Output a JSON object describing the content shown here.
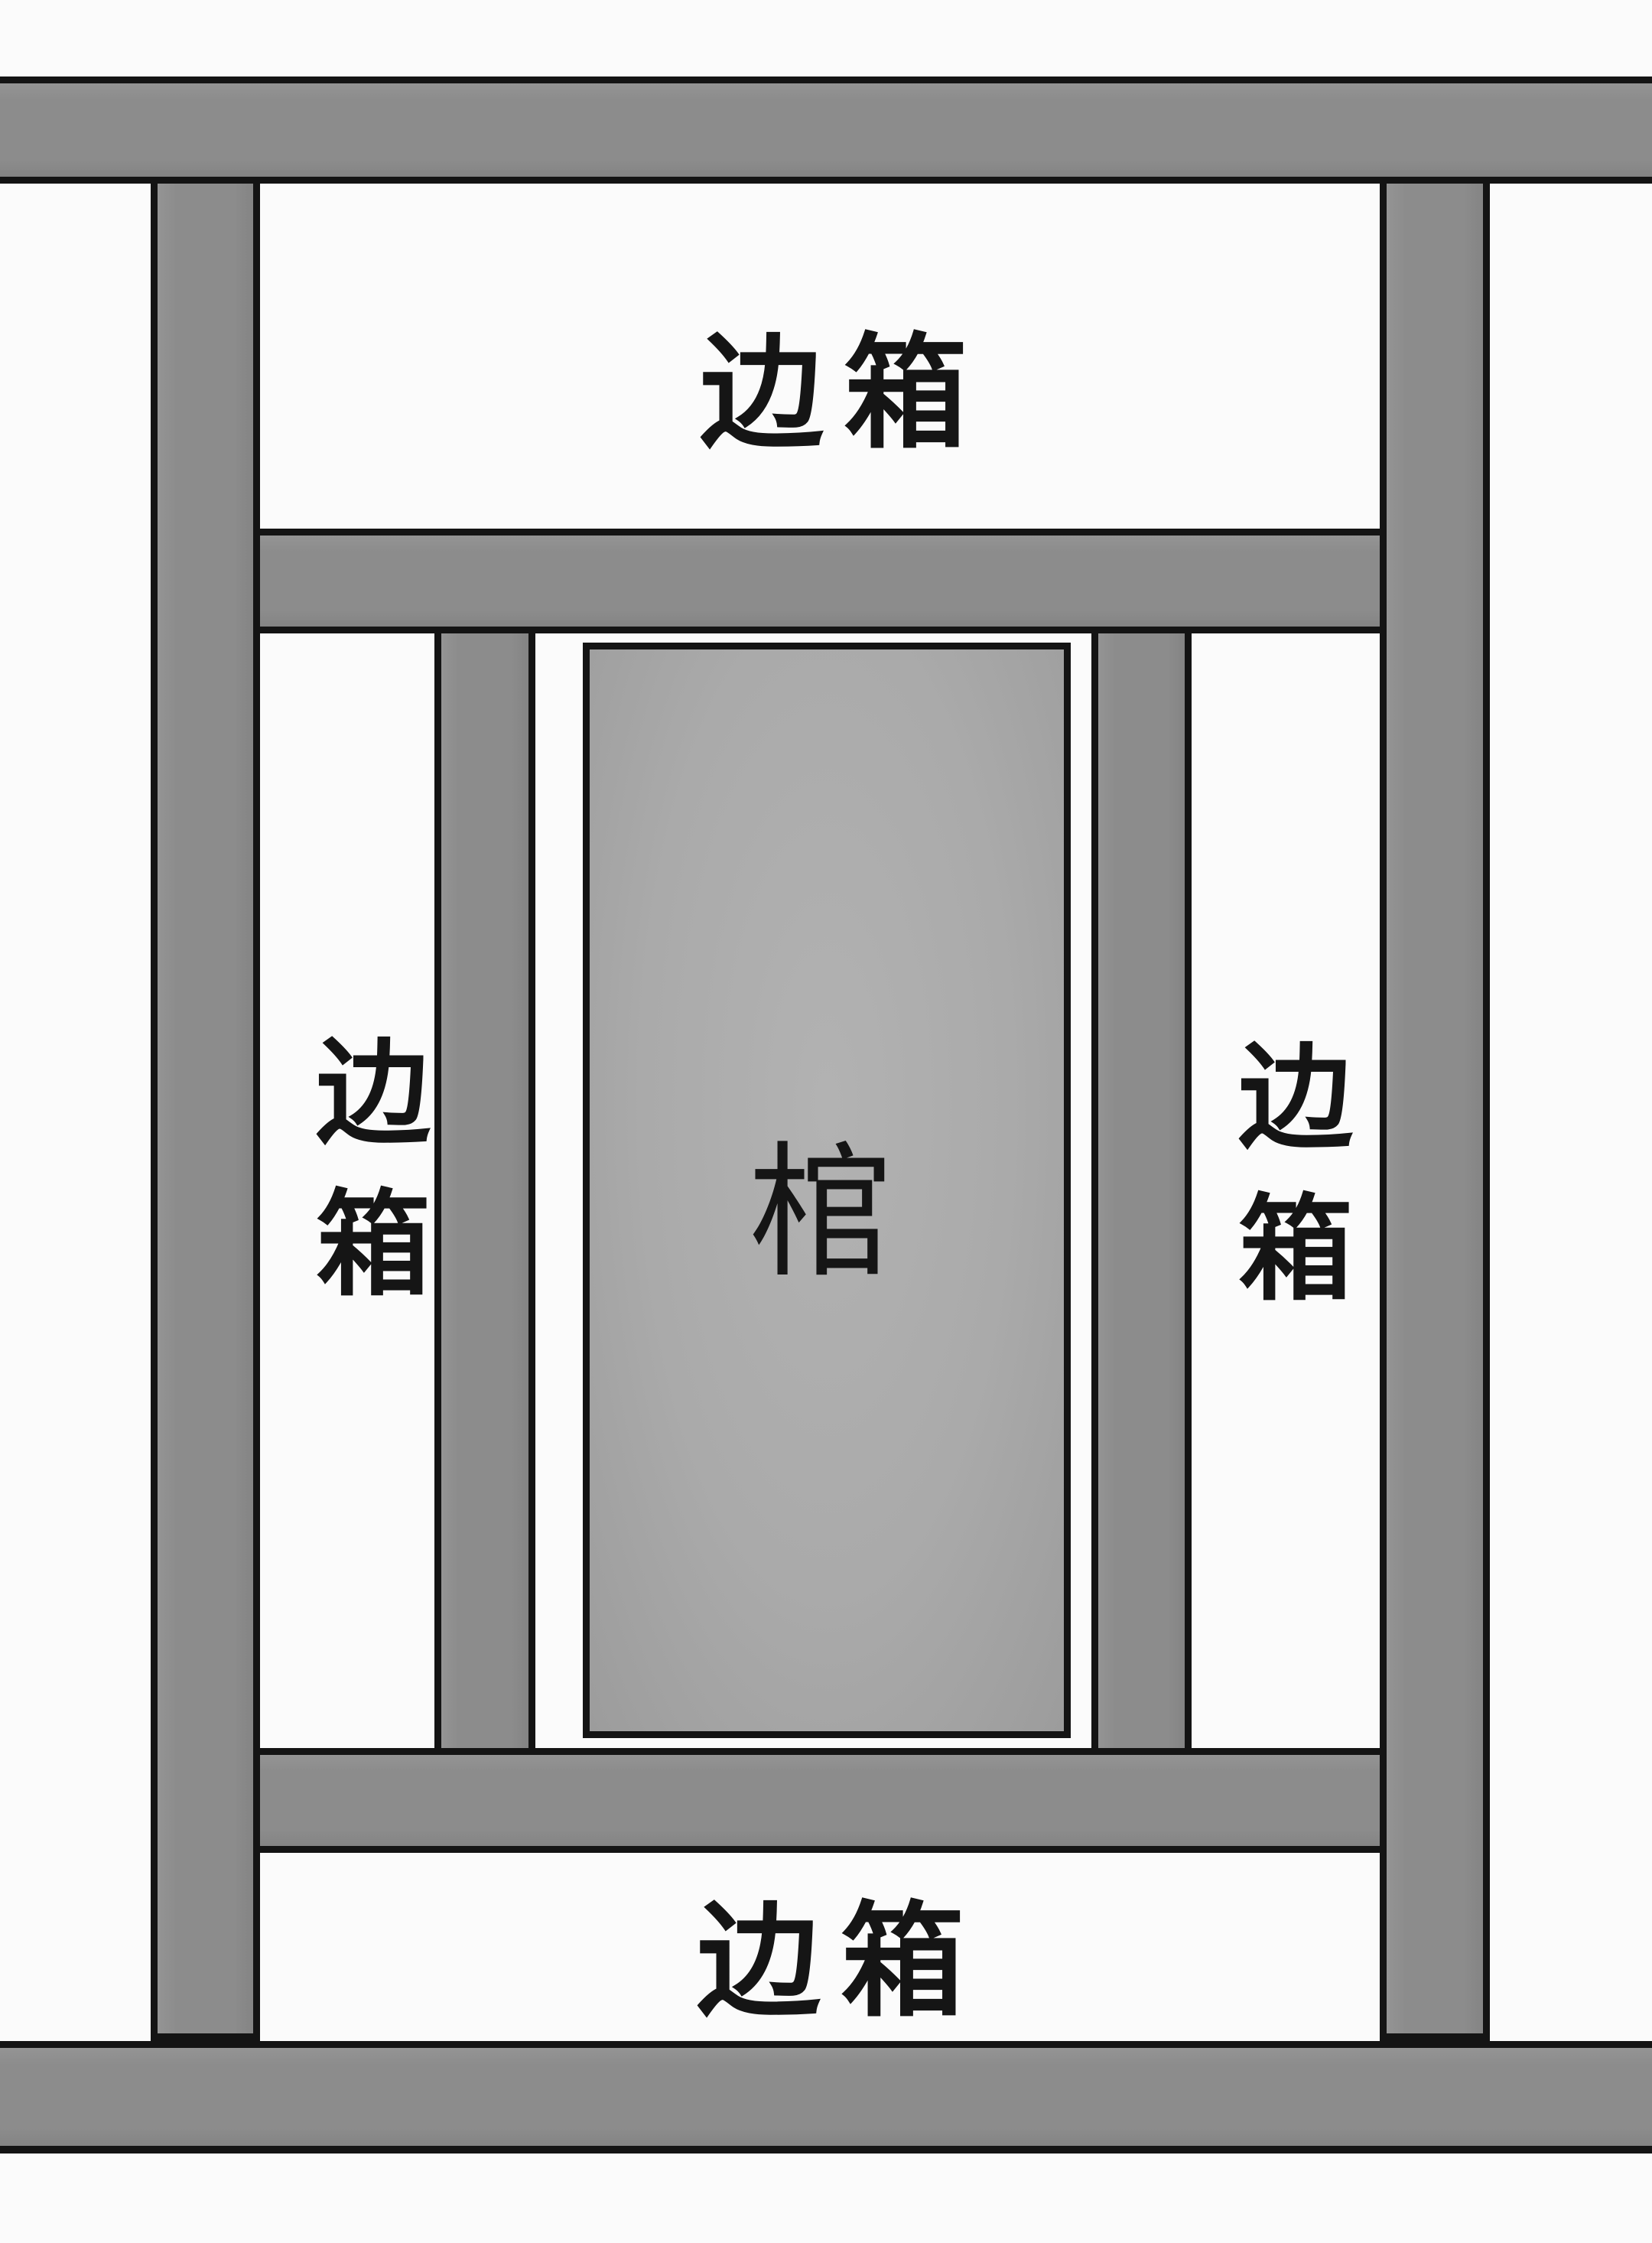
{
  "diagram": {
    "type": "burial-chamber-plan",
    "labels": {
      "top_box": "边箱",
      "left_box": "边箱",
      "right_box": "边箱",
      "bottom_box": "边箱",
      "coffin": "棺"
    }
  },
  "colors": {
    "background": "#fbfbfb",
    "bar_fill": "#8c8c8c",
    "coffin_fill": "#aaaaaa",
    "outline": "#141414",
    "text": "#151515"
  }
}
